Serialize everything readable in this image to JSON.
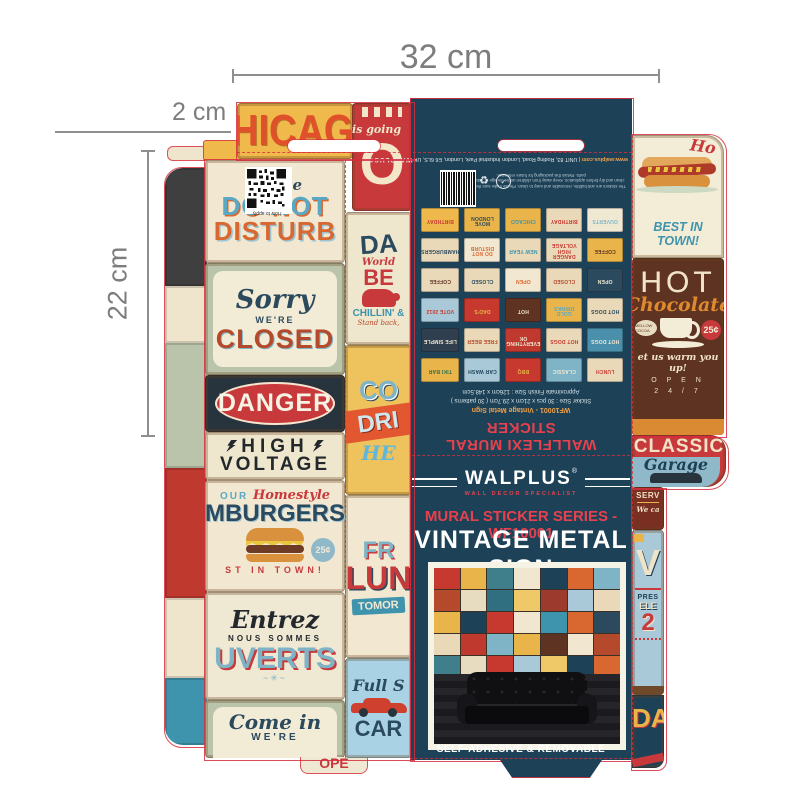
{
  "dimensions": {
    "width_label": "32 cm",
    "flap_label": "2 cm",
    "height_label": "22 cm"
  },
  "colors": {
    "navy": "#1d4157",
    "die_red": "#d72d3c",
    "accent_red": "#e8414d",
    "yellow": "#efba4b",
    "cream": "#f2e8d2",
    "brown": "#5f3322"
  },
  "left_flap": {
    "chicago": "HICAGO",
    "going_sign": {
      "script": "is going",
      "letter": "O"
    },
    "do_not_disturb": {
      "please": "Please",
      "line1": "DO NOT",
      "line2": "DISTURB",
      "qr_caption": "How to apply"
    },
    "closed_sign": {
      "script": "Sorry",
      "small": "WE'RE",
      "big": "CLOSED"
    },
    "danger_sign": {
      "word": "DANGER",
      "line1": "HIGH",
      "line2": "VOLTAGE"
    },
    "hamburgers": {
      "pre": "OUR",
      "script": "Homestyle",
      "big": "MBURGERS",
      "price": "25¢",
      "tag": "ST IN TOWN!"
    },
    "ouverts": {
      "script": "Entrez",
      "small": "NOUS SOMMES",
      "big": "UVERTS",
      "flourish": "~✳~"
    },
    "come_in": {
      "script": "Come in",
      "small": "WE'RE",
      "tuck_fragment": "OPE"
    }
  },
  "middle_strip": {
    "dads_sign": {
      "big": "DA",
      "script": "World",
      "beer": "BE",
      "chillin": "CHILLIN' &",
      "tag": "Stand back,"
    },
    "cold_drinks": {
      "l1": "CO",
      "l2": "DRI",
      "l3": "HE"
    },
    "fresh_lunch": {
      "l1": "FR",
      "l2": "LUN",
      "tag": "TOMOR"
    },
    "car_wash": {
      "script": "Full S",
      "big": "CAR"
    }
  },
  "back_panel": {
    "brand": "WALPLUS®",
    "address": "UNIT 83, Roding Road, London Industrial Park, London, E6 6LS, UK",
    "separator": "|",
    "website": "www.walplus.com",
    "fine_print": "The stickers are anti-bubble, removable and easy to clean. Please make sure the surface is clean and dry before application. Keep away from children under the age of 3 due to small parts. Retain this packaging for future reference.",
    "recycle_icon": "♻",
    "stamp_icon": "✓",
    "sku_line": "WF10001 - Vintage Metal Sign",
    "size_line": "Sticker Size : 30 pcs x 21cm x 29.7cm ( 30 patterns )",
    "finish_line": "Approximate Finish Size : 126cm x 148.5cm",
    "product_line": "WALLFLEXI MURAL STICKER",
    "thumbnails": [
      {
        "label": "LUNCH",
        "bg": "#ead9b8",
        "fg": "#c7392f"
      },
      {
        "label": "CLASSIC",
        "bg": "#7fb4c7",
        "fg": "#f2e8d2"
      },
      {
        "label": "BBQ",
        "bg": "#c7392f",
        "fg": "#e9b54a"
      },
      {
        "label": "CAR WASH",
        "bg": "#a9c9d8",
        "fg": "#1d4157"
      },
      {
        "label": "TIKI BAR",
        "bg": "#e9b54a",
        "fg": "#2f7050"
      },
      {
        "label": "HOT DOGS",
        "bg": "#4a90ad",
        "fg": "#f2e8d2"
      },
      {
        "label": "HOT DOGS",
        "bg": "#ead9b8",
        "fg": "#c7392f"
      },
      {
        "label": "EVERYTHING OK",
        "bg": "#c0392f",
        "fg": "#f2e8d2"
      },
      {
        "label": "FREE BEER",
        "bg": "#ead9b8",
        "fg": "#b5492c"
      },
      {
        "label": "LIFE SIMPLE",
        "bg": "#2f3f4f",
        "fg": "#f2e8d2"
      },
      {
        "label": "HOT DOGS",
        "bg": "#ead9b8",
        "fg": "#2c4a5e"
      },
      {
        "label": "GOLD DRINKS",
        "bg": "#e9b54a",
        "fg": "#5aa8c4"
      },
      {
        "label": "HOT",
        "bg": "#5f3322",
        "fg": "#f0e3c8"
      },
      {
        "label": "DAD'S",
        "bg": "#c7392f",
        "fg": "#e9b54a"
      },
      {
        "label": "VOTE 2012",
        "bg": "#a9c9d8",
        "fg": "#c7392f"
      },
      {
        "label": "OPEN",
        "bg": "#2c4a5e",
        "fg": "#f2e8d2"
      },
      {
        "label": "CLOSED",
        "bg": "#ead9b8",
        "fg": "#b5492c"
      },
      {
        "label": "OPEN",
        "bg": "#f2e8d2",
        "fg": "#d96830"
      },
      {
        "label": "CLOSED",
        "bg": "#ead9b8",
        "fg": "#2c4a5e"
      },
      {
        "label": "COFFEE",
        "bg": "#ead9b8",
        "fg": "#5f3322"
      },
      {
        "label": "COFFEE",
        "bg": "#e9b54a",
        "fg": "#5f3322"
      },
      {
        "label": "DANGER HIGH VOLTAGE",
        "bg": "#ead9b8",
        "fg": "#c7392f"
      },
      {
        "label": "NEW YEAR",
        "bg": "#ead9b8",
        "fg": "#3e93ad"
      },
      {
        "label": "DO NOT DISTURB",
        "bg": "#f2e8d2",
        "fg": "#d96830"
      },
      {
        "label": "HAMBURGERS",
        "bg": "#ead9b8",
        "fg": "#2c4a5e"
      },
      {
        "label": "OUVERTS",
        "bg": "#efe9d4",
        "fg": "#7fb4c7"
      },
      {
        "label": "BIRTHDAY",
        "bg": "#ead9b8",
        "fg": "#c7392f"
      },
      {
        "label": "CHICAGO",
        "bg": "#e9b54a",
        "fg": "#3e93ad"
      },
      {
        "label": "MOVE LONDON",
        "bg": "#e9b54a",
        "fg": "#2c4a5e"
      },
      {
        "label": "BIRTHDAY",
        "bg": "#efb84c",
        "fg": "#c7392f"
      }
    ]
  },
  "front_panel": {
    "brand": "WALPLUS",
    "reg": "®",
    "tagline": "WALL DECOR SPECIALIST",
    "series": "MURAL STICKER SERIES - WF10001",
    "title": "VINTAGE METAL SIGN",
    "footer": "SELF-ADHESIVE & REMOVABLE",
    "photo": {
      "collage_colors": [
        "#c7392f",
        "#e9b54a",
        "#3f7f8c",
        "#f1e7d0",
        "#1d4157",
        "#d96830",
        "#7fb4c7",
        "#b5492c",
        "#e8dcc0",
        "#2f6f7f",
        "#efc868",
        "#9c3a2e",
        "#a9c9d8",
        "#ead9b8",
        "#e9b54a",
        "#1d4157",
        "#c7392f",
        "#f1e7d0",
        "#3e93ad",
        "#d96830",
        "#2c4a5e",
        "#ead9b8",
        "#c0392f",
        "#7fb4c7",
        "#e9b54a",
        "#5f3322",
        "#f1e7d0",
        "#b5492c",
        "#3f7f8c",
        "#e8dcc0",
        "#c7392f",
        "#a9c9d8",
        "#efc868",
        "#1d4157",
        "#d96830"
      ]
    }
  },
  "right_flap": {
    "hotdog_fragment": "Ho",
    "best": "BEST IN TOWN!",
    "hot_chocolate": {
      "hot": "HOT",
      "script": "Chocolate",
      "price": "25¢",
      "badge": "MELLOW COCOA",
      "warm": "et us warm you up!",
      "open": "O P E N",
      "hours": "2 4 / 7"
    },
    "garage": {
      "classic": "CLASSIC",
      "script": "Garage",
      "service": "SERV",
      "we": "We ca"
    },
    "vote": {
      "v": "V",
      "pres": "PRES",
      "ele": "ELE",
      "year": "2"
    },
    "dads": "DA"
  },
  "left_strip_tiles": [
    {
      "bg": "#3f3f3f",
      "h": 118
    },
    {
      "bg": "#efe5cd",
      "h": 57
    },
    {
      "bg": "#b9c4ab",
      "h": 125
    },
    {
      "bg": "#c0392f",
      "h": 130
    },
    {
      "bg": "#efe5cd",
      "h": 80
    },
    {
      "bg": "#3e93ad",
      "h": 67
    }
  ]
}
